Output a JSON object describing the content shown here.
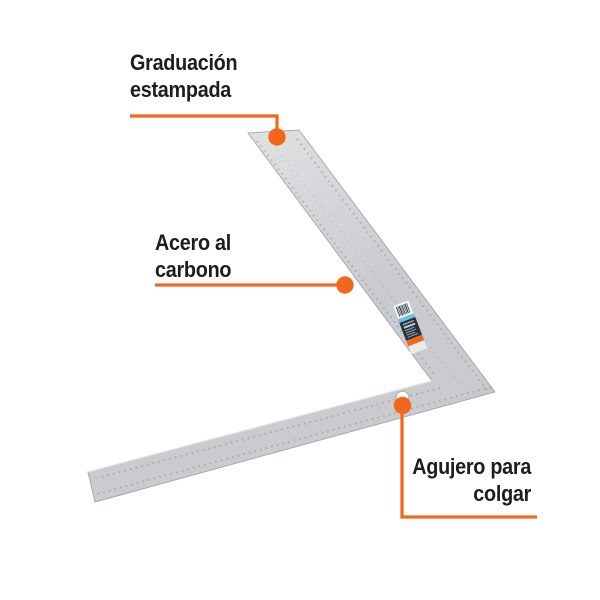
{
  "product": {
    "type": "framing-square",
    "description": "carpenter steel framing square with annotation callouts",
    "features": [
      "stamped-graduation",
      "carbon-steel-body",
      "hanging-hole",
      "brand-label-sticker",
      "barcode"
    ]
  },
  "callouts": [
    {
      "id": "graduacion-estampada",
      "lines": [
        "Graduación",
        "estampada"
      ]
    },
    {
      "id": "acero-al-carbono",
      "lines": [
        "Acero al",
        "carbono"
      ]
    },
    {
      "id": "agujero-para-colgar",
      "lines": [
        "Agujero para",
        "colgar"
      ]
    }
  ],
  "colors": {
    "accent": "#f2671c",
    "text": "#1d1d1b",
    "background": "#ffffff",
    "steel_light": "#dfe1e3",
    "steel_mid": "#c9cbce",
    "steel_dark": "#b2b5b8",
    "steel_edge": "#a8abae",
    "graduation_mark": "#8f9296",
    "label_barcode_bg": "#f4f5f6",
    "label_blue": "#6cc0e6",
    "label_navy": "#24303c",
    "label_orange": "#f2671c"
  }
}
